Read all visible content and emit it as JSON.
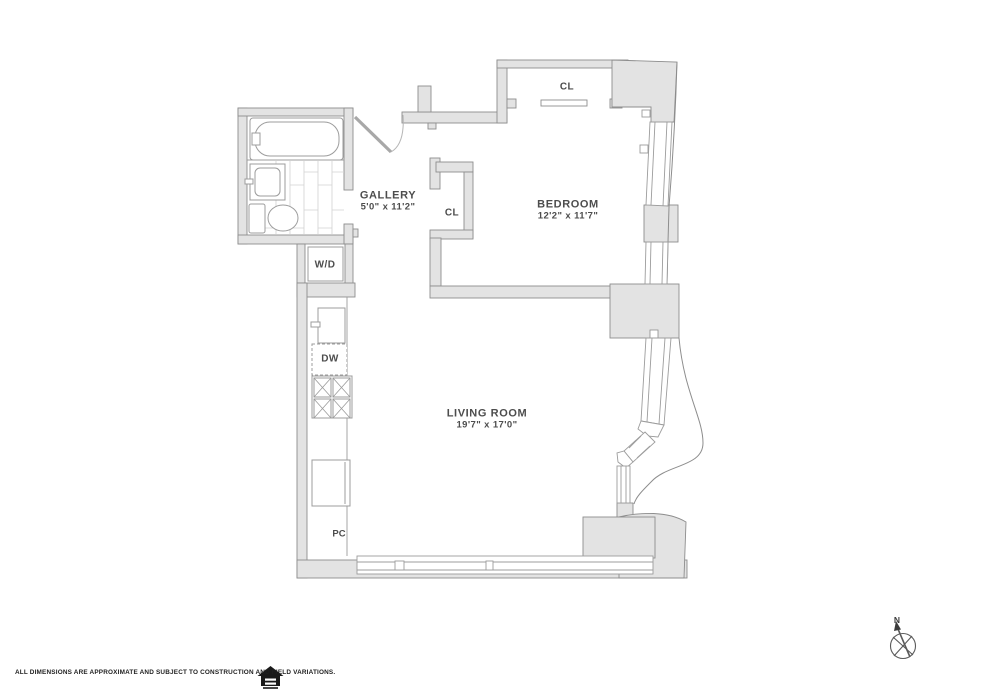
{
  "colors": {
    "wall_fill": "#e3e3e3",
    "wall_stroke": "#8d8d8d",
    "fixture_stroke": "#9c9c9c",
    "tile_line": "#d2d2d2",
    "label_text": "#4d4d4d",
    "footer_text": "#1f1f1f"
  },
  "plan": {
    "rooms": {
      "gallery": {
        "name": "GALLERY",
        "dimensions": "5'0\" x 11'2\""
      },
      "bedroom": {
        "name": "BEDROOM",
        "dimensions": "12'2\" x 11'7\""
      },
      "living_room": {
        "name": "LIVING ROOM",
        "dimensions": "19'7\" x 17'0\""
      }
    },
    "labels": {
      "bedroom_closet": "CL",
      "hall_closet": "CL",
      "washer_dryer": "W/D",
      "dishwasher": "DW",
      "pipe_chase": "PC"
    },
    "compass": {
      "north": "N"
    }
  },
  "icons": {
    "footer_logo": "equal-housing-opportunity-logo",
    "compass": "compass-rose"
  },
  "footer": {
    "disclaimer": "ALL DIMENSIONS ARE APPROXIMATE AND SUBJECT TO CONSTRUCTION AND FIELD VARIATIONS."
  }
}
